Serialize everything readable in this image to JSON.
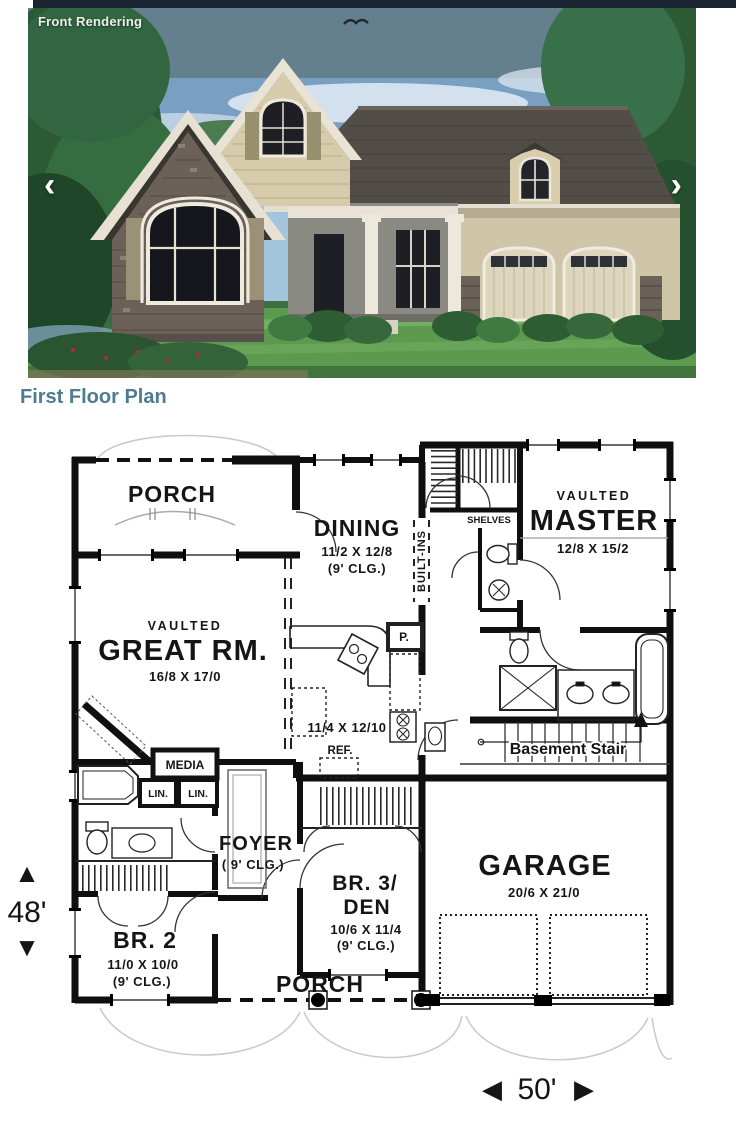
{
  "page": {
    "heading": "First Floor Plan"
  },
  "carousel": {
    "label": "Front Rendering",
    "prev_icon": "‹",
    "next_icon": "›"
  },
  "plan": {
    "porch_top": "PORCH",
    "dining": {
      "name": "DINING",
      "dims": "11/2 X 12/8",
      "clg": "(9' CLG.)"
    },
    "built_ins": "BUILT-INS",
    "shelves": "SHELVES",
    "master": {
      "vaulted": "VAULTED",
      "name": "MASTER",
      "dims": "12/8 X 15/2"
    },
    "great_rm": {
      "vaulted": "VAULTED",
      "name": "GREAT RM.",
      "dims": "16/8 X 17/0"
    },
    "kitchen": {
      "dims": "11/4 X 12/10",
      "ref": "REF.",
      "pantry": "P."
    },
    "basement_stair": "Basement Stair",
    "media": "MEDIA",
    "lin1": "LIN.",
    "lin2": "LIN.",
    "foyer": {
      "name": "FOYER",
      "clg": "( 9' CLG.)"
    },
    "br3": {
      "name1": "BR. 3/",
      "name2": "DEN",
      "dims": "10/6 X 11/4",
      "clg": "(9' CLG.)"
    },
    "br2": {
      "name": "BR. 2",
      "dims": "11/0 X 10/0",
      "clg": "(9' CLG.)"
    },
    "garage": {
      "name": "GARAGE",
      "dims": "20/6 X 21/0"
    },
    "porch_bottom": "PORCH",
    "depth": {
      "value": "48'",
      "up": "▲",
      "down": "▼"
    },
    "width": {
      "value": "50'",
      "left": "◀",
      "right": "▶"
    }
  },
  "colors": {
    "heading": "#4e7a92",
    "stair_label": "#4d7fa8",
    "top_bar": "#1b2433"
  }
}
